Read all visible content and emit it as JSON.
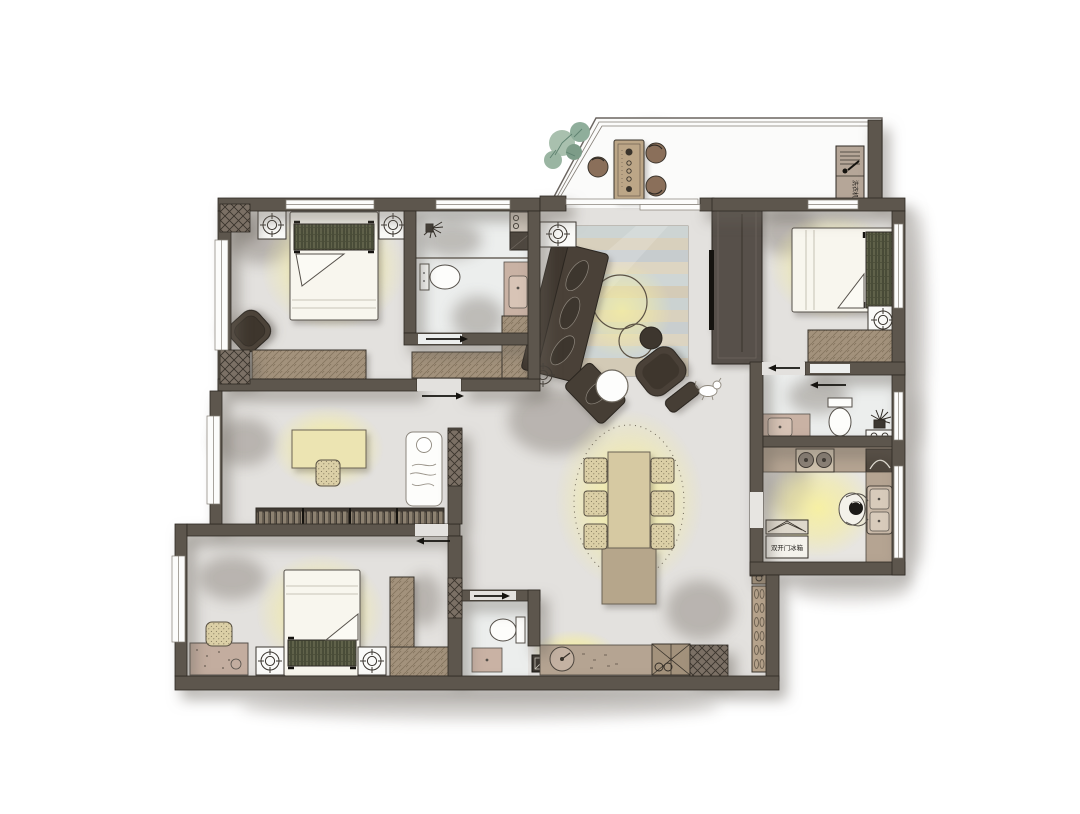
{
  "document": {
    "type": "residential-apartment-floor-plan",
    "background": "#ffffff"
  },
  "labels": {
    "washing_machine": "洗衣机",
    "fridge": "双开门冰箱"
  },
  "palette": {
    "wall": "#5d564d",
    "wall_outline": "#2f2a24",
    "floor": "#e3e1de",
    "balcony_floor": "#ebebe9",
    "bath_floor": "#eceeed",
    "lamp_glow": "#f6efa0",
    "wood": "#a3927c",
    "wood_dark": "#8b7b66",
    "sofa": "#4a4138",
    "bed_linen": "#f8f6ee",
    "headboard_plaid": "#60624a",
    "rug_blue": "#cdd4d3",
    "rug_tan": "#d8d0bd",
    "vanity_pink": "#c9b2a4",
    "plant_green": "#8fae9b",
    "shadow": "#7e776f"
  },
  "icons": {
    "ceiling_light": "crosshair-circle",
    "ac_unit": "boxed-crosshair",
    "shower_head": "spray-star",
    "door_slide": "arrow",
    "stove": "two-burner-circles",
    "plant": "leaf-cluster"
  }
}
